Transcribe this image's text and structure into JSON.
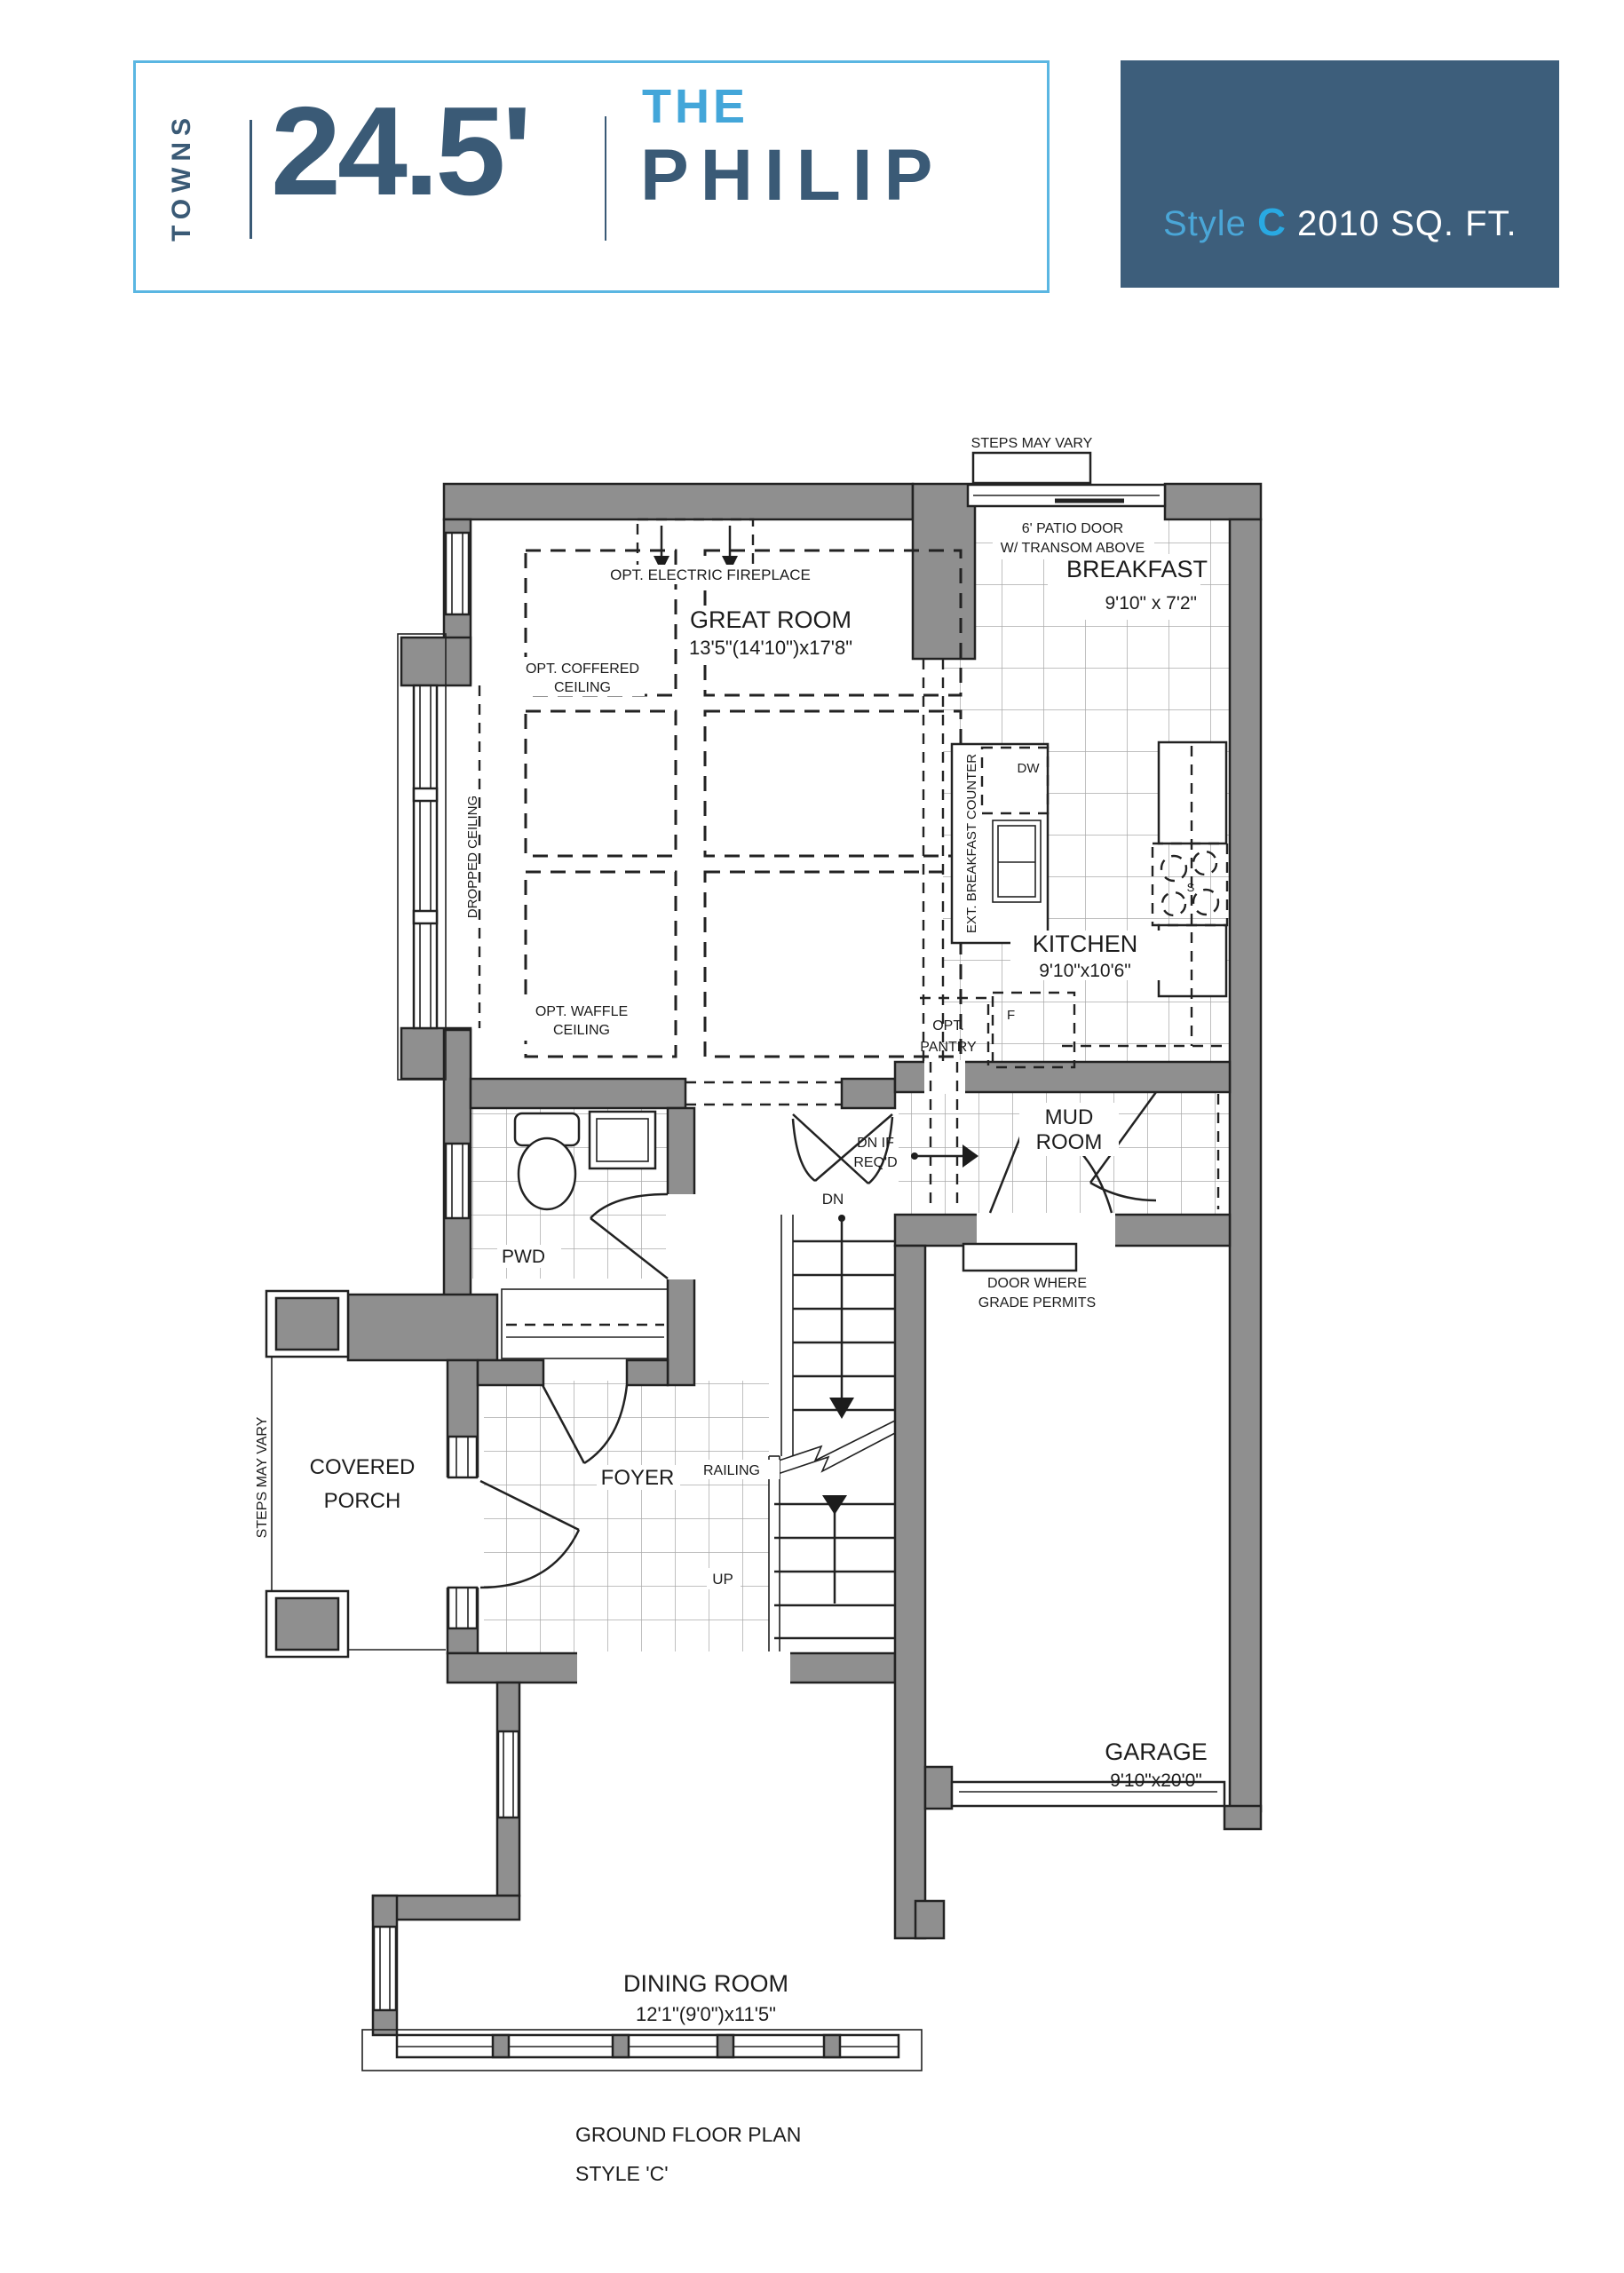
{
  "header": {
    "series": "TOWNS",
    "width_label": "24.5'",
    "name_prefix": "THE",
    "name": "PHILIP"
  },
  "badge": {
    "style_label": "Style",
    "style_letter": "C",
    "area": "2010 SQ. FT."
  },
  "colors": {
    "dark_slate": "#3a5a76",
    "badge_bg": "#3d5e7b",
    "light_blue": "#43a6d9",
    "bright_blue": "#29a9e2",
    "box_border": "#5ab6e2",
    "wall_gray": "#8f8f8f"
  },
  "plan": {
    "labels": {
      "steps_top": "STEPS MAY VARY",
      "patio_door_1": "6' PATIO DOOR",
      "patio_door_2": "W/ TRANSOM ABOVE",
      "breakfast": "BREAKFAST",
      "breakfast_dims": "9'10\" x 7'2\"",
      "opt_fireplace": "OPT. ELECTRIC FIREPLACE",
      "great_room": "GREAT ROOM",
      "great_room_dims": "13'5\"(14'10\")x17'8\"",
      "opt_coffered_1": "OPT. COFFERED",
      "opt_coffered_2": "CEILING",
      "opt_waffle_1": "OPT. WAFFLE",
      "opt_waffle_2": "CEILING",
      "dropped_ceiling": "DROPPED CEILING",
      "ext_counter": "EXT. BREAKFAST COUNTER",
      "dw": "DW",
      "kitchen": "KITCHEN",
      "kitchen_dims": "9'10\"x10'6\"",
      "opt_pantry_1": "OPT.",
      "opt_pantry_2": "PANTRY",
      "fridge": "F",
      "stove": "S",
      "mud_room_1": "MUD",
      "mud_room_2": "ROOM",
      "dn_if_reqd_1": "DN IF",
      "dn_if_reqd_2": "REQ'D",
      "dn": "DN",
      "up": "UP",
      "railing": "RAILING",
      "door_grade_1": "DOOR WHERE",
      "door_grade_2": "GRADE PERMITS",
      "pwd": "PWD",
      "foyer": "FOYER",
      "covered_porch_1": "COVERED",
      "covered_porch_2": "PORCH",
      "steps_left": "STEPS MAY VARY",
      "dining": "DINING ROOM",
      "dining_dims": "12'1\"(9'0\")x11'5\"",
      "garage": "GARAGE",
      "garage_dims": "9'10\"x20'0\""
    }
  },
  "footer": {
    "line1": "GROUND FLOOR PLAN",
    "line2": "STYLE 'C'"
  }
}
